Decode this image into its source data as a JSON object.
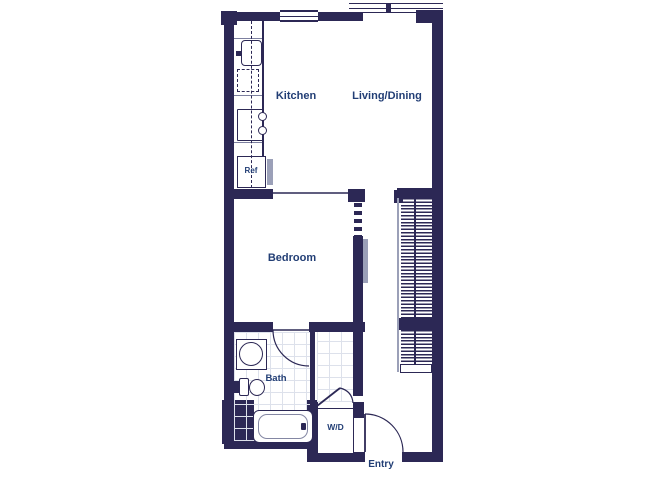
{
  "colors": {
    "wall": "#2c2855",
    "label": "#223e75",
    "accent_gray": "#9ba0b8",
    "tile_grid": "#dde1eb"
  },
  "rooms": {
    "kitchen": "Kitchen",
    "living_dining": "Living/Dining",
    "bedroom": "Bedroom",
    "bath": "Bath",
    "entry": "Entry"
  },
  "fixtures": {
    "refrigerator": "Ref",
    "washer_dryer": "W/D"
  }
}
